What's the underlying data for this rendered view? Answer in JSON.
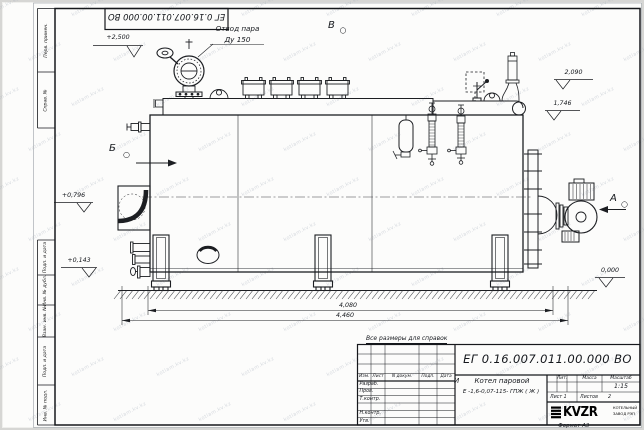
{
  "sheet": {
    "top_designation": "ЕГ 0.16.007.011.00.000  ВО",
    "note": "Все размеры для справок",
    "format_label": "Формат А3",
    "watermark": "kotlam.kv.kz"
  },
  "margin_fields": [
    "Перв. примен.",
    "Справ. №",
    "Подп. и дата",
    "Инв. № дубл.",
    "Взам. инв. №",
    "Подп. и дата",
    "Инв. № подл."
  ],
  "annotations": {
    "steam_outlet": {
      "line1": "Отвод пара",
      "line2": "Ду 150"
    },
    "views": {
      "b": "Б",
      "v": "В",
      "a": "А"
    },
    "elevations": {
      "top": "+2,500",
      "rear_high": "2,090",
      "rear_mid": "1,746",
      "front_mid": "+0,796",
      "front_low": "+0,143",
      "ground": "0,000"
    },
    "dimensions": {
      "inner": "4,080",
      "overall": "4,460"
    }
  },
  "title_block": {
    "designation": "ЕГ 0.16.007.011.00.000  ВО",
    "product_name_line1": "Котел паровой",
    "product_name_line2": "Е -1,6-0,07-115- ГПЖ ( Ж )",
    "header_cols": [
      "Изм.",
      "Лист",
      "N докум.",
      "Подп.",
      "Дата"
    ],
    "row_labels": [
      "Разраб.",
      "Пров.",
      "Т.контр.",
      "Н.контр.",
      "Утв."
    ],
    "lit_header": "Лит.",
    "mass_header": "Масса",
    "scale_header": "Масштаб",
    "lit_mark": "И",
    "scale_value": "1:15",
    "sheet_no": "Лист 1",
    "sheets_label": "Листов",
    "sheets_total": "2",
    "logo_text": "KVZR",
    "company_line1": "КОТЕЛЬНЫЙ",
    "company_line2": "ЗАВОД РЭП"
  }
}
